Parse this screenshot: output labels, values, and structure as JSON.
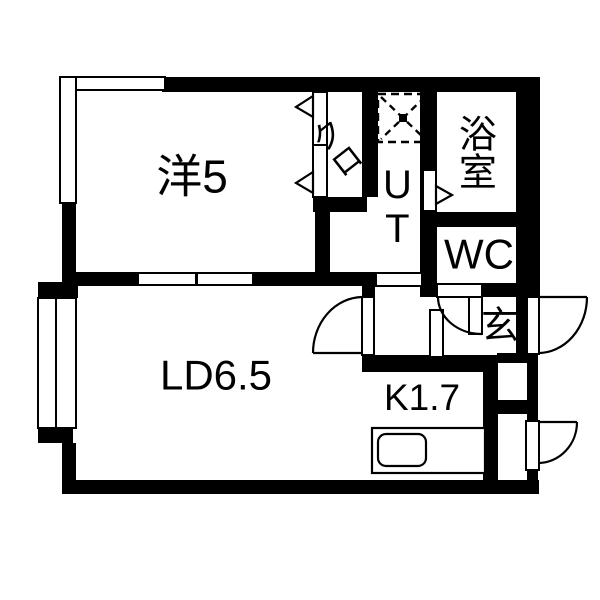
{
  "plan": {
    "title": "1LDK floor plan",
    "colors": {
      "wall": "#000000",
      "floor": "#ffffff",
      "line": "#000000"
    },
    "rooms": {
      "western": {
        "label": "洋5"
      },
      "living": {
        "label": "LD6.5"
      },
      "kitchen": {
        "label": "K1.7"
      },
      "closet": {
        "label": "クロ"
      },
      "utility": {
        "label": "UT"
      },
      "bath": {
        "label": "浴室"
      },
      "wc": {
        "label": "WC"
      },
      "entrance": {
        "label": "玄"
      }
    }
  }
}
